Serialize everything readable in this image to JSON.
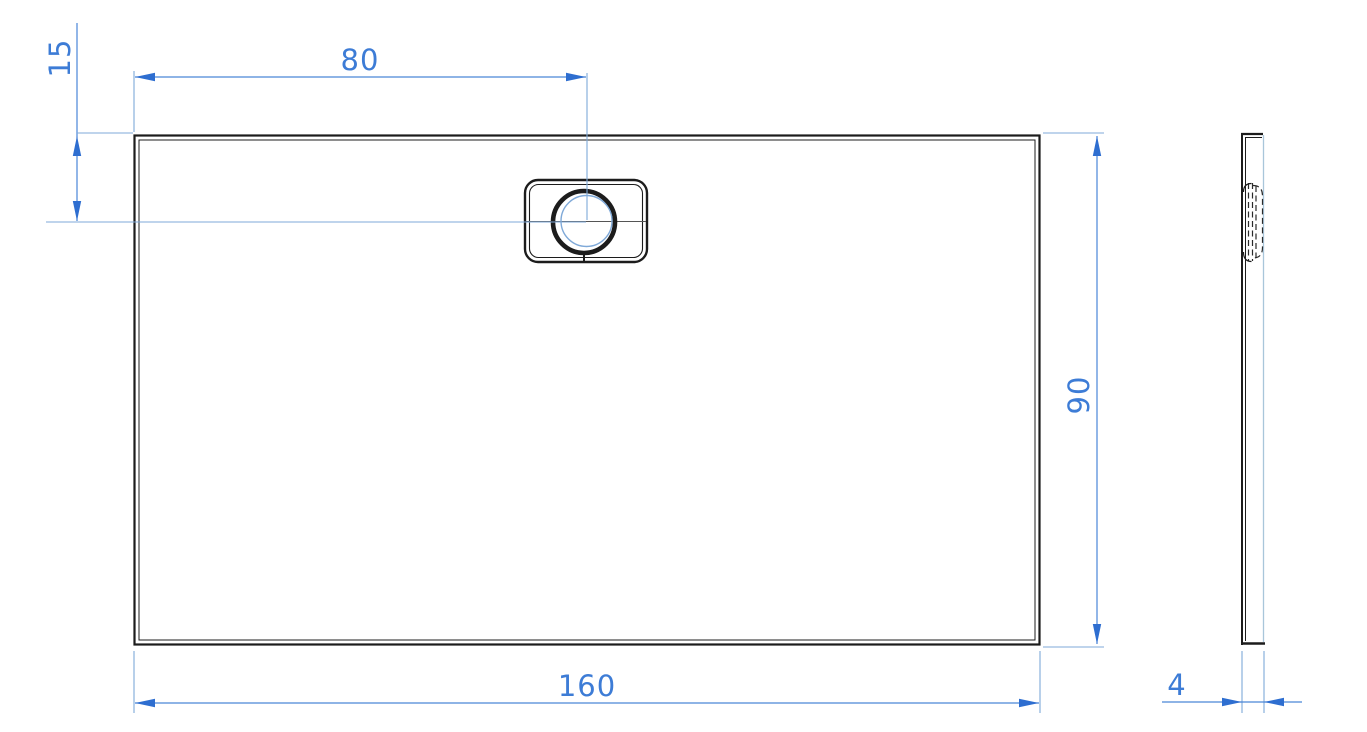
{
  "dimensions": {
    "drain_offset_from_left": "80",
    "drain_offset_from_top": "15",
    "tray_width": "90",
    "tray_length": "160",
    "tray_thickness": "4"
  },
  "colors": {
    "background": "#ffffff",
    "drawing_line": "#1c1c1c",
    "dimension_line": "#4a86d8",
    "extension_line": "#7fa9d8",
    "arrow": "#2e6ed0",
    "dimension_text": "#3d7cd6",
    "tangent_edge": "#a9c6da",
    "seam_line": "#555555"
  }
}
